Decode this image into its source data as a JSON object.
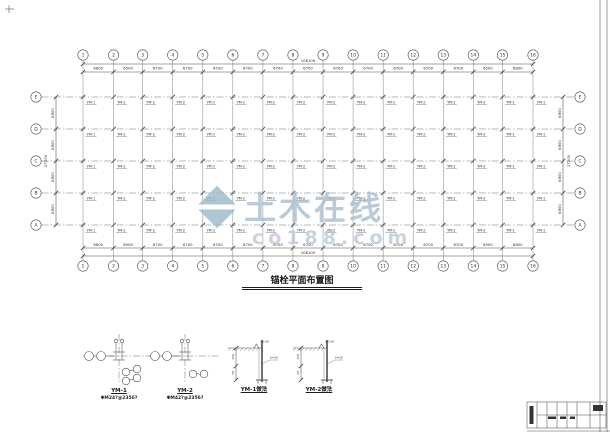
{
  "watermark": {
    "brand": "土木在线",
    "domain": "co188.com"
  },
  "plan": {
    "title": "锚栓平面布置图",
    "column_axes": [
      "1",
      "2",
      "3",
      "4",
      "5",
      "6",
      "7",
      "8",
      "9",
      "10",
      "11",
      "12",
      "13",
      "14",
      "15",
      "16"
    ],
    "column_spans": [
      "6800",
      "6500",
      "6700",
      "6700",
      "6700",
      "6700",
      "6700",
      "6700",
      "6700",
      "6700",
      "6700",
      "6700",
      "6700",
      "6500",
      "6800"
    ],
    "total_width": "106100",
    "row_axes": [
      "E",
      "D",
      "C",
      "B",
      "A"
    ],
    "row_spans": [
      "6800",
      "6800",
      "6800",
      "6800"
    ],
    "total_height": "27200",
    "anchor_by_column": [
      "YM-1",
      "YM-1",
      "YM-2",
      "YM-2",
      "YM-2",
      "YM-2",
      "YM-2",
      "YM-2",
      "YM-2",
      "YM-2",
      "YM-2",
      "YM-2",
      "YM-2",
      "YM-2",
      "YM-1",
      "YM-1"
    ]
  },
  "details": {
    "ym1": {
      "label": "YM-1",
      "note": "ΦM24?@235δ?"
    },
    "ym2": {
      "label": "YM-2",
      "note": "ΦM42?@235δ?"
    },
    "ym1_method": {
      "label": "YM-1做法"
    },
    "ym2_method": {
      "label": "YM-2做法"
    },
    "annotations": {
      "elev": "±0.00",
      "thick": "δ=20",
      "d1": "150",
      "d2": "50",
      "d3": "200"
    }
  }
}
